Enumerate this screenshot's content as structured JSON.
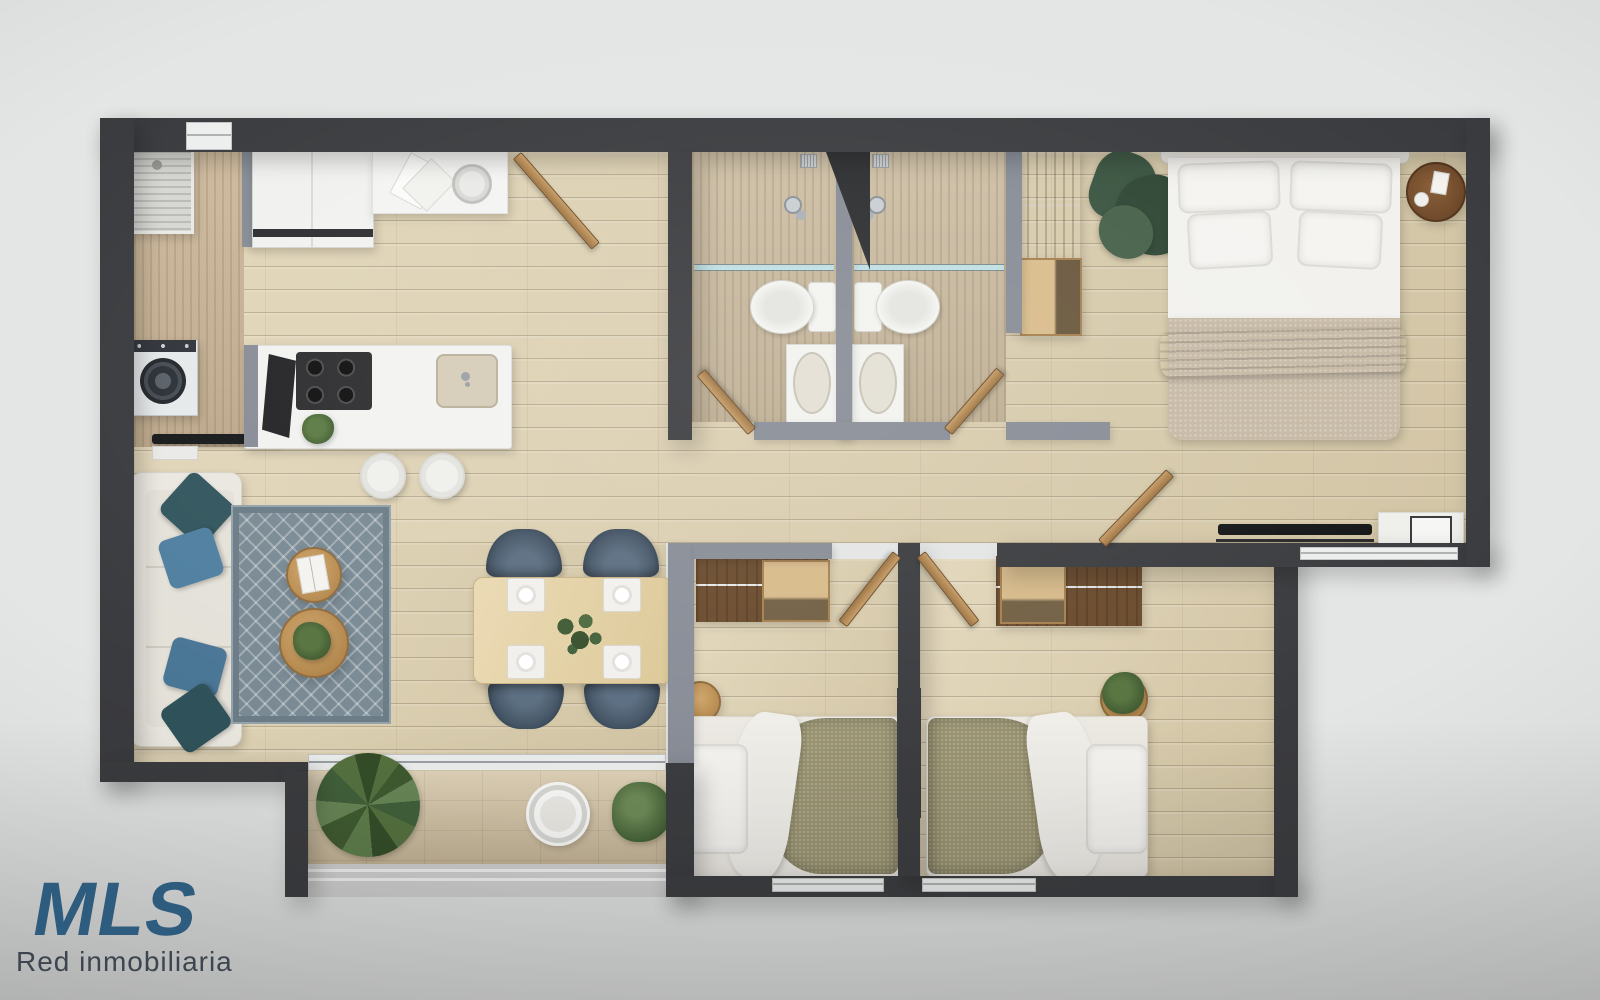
{
  "logo": {
    "brand": "MLS",
    "subtitle": "Red inmobiliaria"
  },
  "colors": {
    "bg": "#e4e5e5",
    "wall-dark": "#3a3b3e",
    "wall-gray": "#878c96",
    "wood-base": "#ddcfad",
    "travertine": "#c9b99c",
    "balcony-tile": "#d9caab",
    "rug-base": "#798a94",
    "accent-teal": "#3c646d",
    "pillow-blue": "#4f7fa0",
    "olive": "#98926f",
    "furniture-wood": "#c0915a",
    "dark-wood": "#6a4a2c",
    "logo-blue": "#2d5c7e",
    "logo-sub": "#3d4550",
    "white-goods": "#f1f1ef"
  }
}
